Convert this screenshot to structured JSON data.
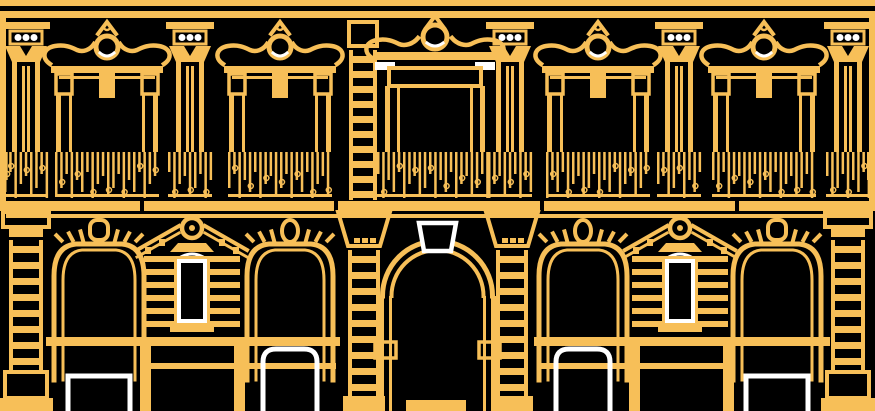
{
  "palette": {
    "background": "#000000",
    "line": "#F7BF58",
    "highlight": "#FFFFFF"
  },
  "canvas": {
    "width": 875,
    "height": 411
  },
  "facade": {
    "cornice_bands": [
      {
        "y": 0,
        "h": 6
      },
      {
        "y": 11,
        "h": 7
      }
    ],
    "edge_strips": [
      {
        "x": 0,
        "y": 18,
        "w": 6,
        "h": 193
      },
      {
        "x": 869,
        "y": 18,
        "w": 6,
        "h": 193
      }
    ],
    "upper_pilasters": [
      26,
      190,
      510,
      679,
      848
    ],
    "upper_windows": [
      {
        "cx": 107,
        "w": 112,
        "central": false
      },
      {
        "cx": 280,
        "w": 112,
        "central": false
      },
      {
        "cx": 435,
        "w": 124,
        "central": true
      },
      {
        "cx": 598,
        "w": 112,
        "central": false
      },
      {
        "cx": 764,
        "w": 112,
        "central": false
      }
    ],
    "upper_quoin": {
      "x": 349,
      "w": 28,
      "y0": 22,
      "y1": 200
    },
    "railing": {
      "y": 152,
      "h": 46,
      "bar_heights": [
        46,
        28,
        40,
        20,
        46,
        32,
        24,
        44,
        36,
        22
      ]
    },
    "balcony_floor": {
      "y": 201,
      "h": 10,
      "gaps": [
        140,
        334,
        540,
        735
      ]
    },
    "string_course": {
      "y": 214,
      "h": 4
    },
    "ground": {
      "side_pilasters": [
        26,
        848
      ],
      "portal": {
        "cx": 437.5,
        "outer_r": 55,
        "inner_r": 46,
        "spring_y": 296,
        "keystone_points": [
          [
            419,
            223
          ],
          [
            456,
            223
          ],
          [
            451,
            251
          ],
          [
            424,
            251
          ]
        ],
        "ladders": [
          364,
          512
        ]
      },
      "bays": [
        {
          "cx": 99,
          "w": 90,
          "keystone": "block",
          "door": "square"
        },
        {
          "cx": 290,
          "w": 86,
          "keystone": "oval",
          "door": "round"
        },
        {
          "cx": 583,
          "w": 88,
          "keystone": "oval",
          "door": "round"
        },
        {
          "cx": 777,
          "w": 88,
          "keystone": "block",
          "door": "square"
        }
      ],
      "piers": [
        192,
        680
      ],
      "beams": [
        {
          "x": 46,
          "y": 337,
          "w": 294,
          "h": 9
        },
        {
          "x": 534,
          "y": 337,
          "w": 296,
          "h": 9
        }
      ],
      "transoms": [
        {
          "x": 150,
          "y": 363,
          "w": 186,
          "h": 6
        },
        {
          "x": 539,
          "y": 363,
          "w": 186,
          "h": 6
        }
      ],
      "posts": [
        140,
        234,
        629,
        723
      ],
      "threshold": {
        "x": 406,
        "y": 400,
        "w": 60,
        "h": 11
      }
    }
  }
}
